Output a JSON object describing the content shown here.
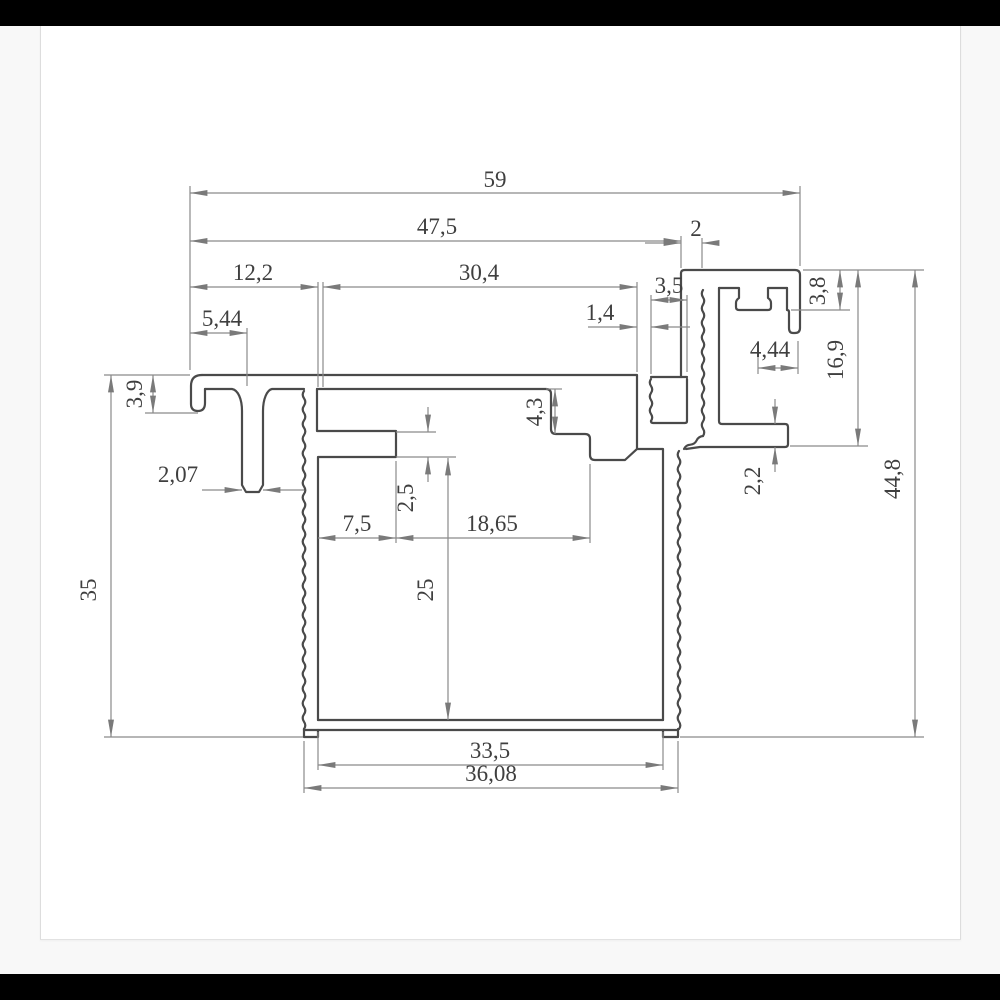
{
  "page": {
    "background": "#f8f8f8",
    "top_bar_color": "#000000",
    "bottom_bar_color": "#000000",
    "card_background": "#ffffff"
  },
  "drawing": {
    "type": "technical-cross-section-profile",
    "decimal_separator": ",",
    "line_color": "#4a4a4a",
    "dim_line_color": "#8a8a8a",
    "text_color": "#3f3f3f",
    "dimensions": {
      "d59": "59",
      "d475": "47,5",
      "d2": "2",
      "d122": "12,2",
      "d304": "30,4",
      "d544": "5,44",
      "d35s": "3,5",
      "d14": "1,4",
      "d39": "3,9",
      "d207": "2,07",
      "d43": "4,3",
      "d25s": "2,5",
      "d75": "7,5",
      "d1865": "18,65",
      "d25": "25",
      "d35": "35",
      "d335": "33,5",
      "d3608": "36,08",
      "d22": "2,2",
      "d38": "3,8",
      "d169": "16,9",
      "d448": "44,8",
      "d444": "4,44"
    }
  }
}
